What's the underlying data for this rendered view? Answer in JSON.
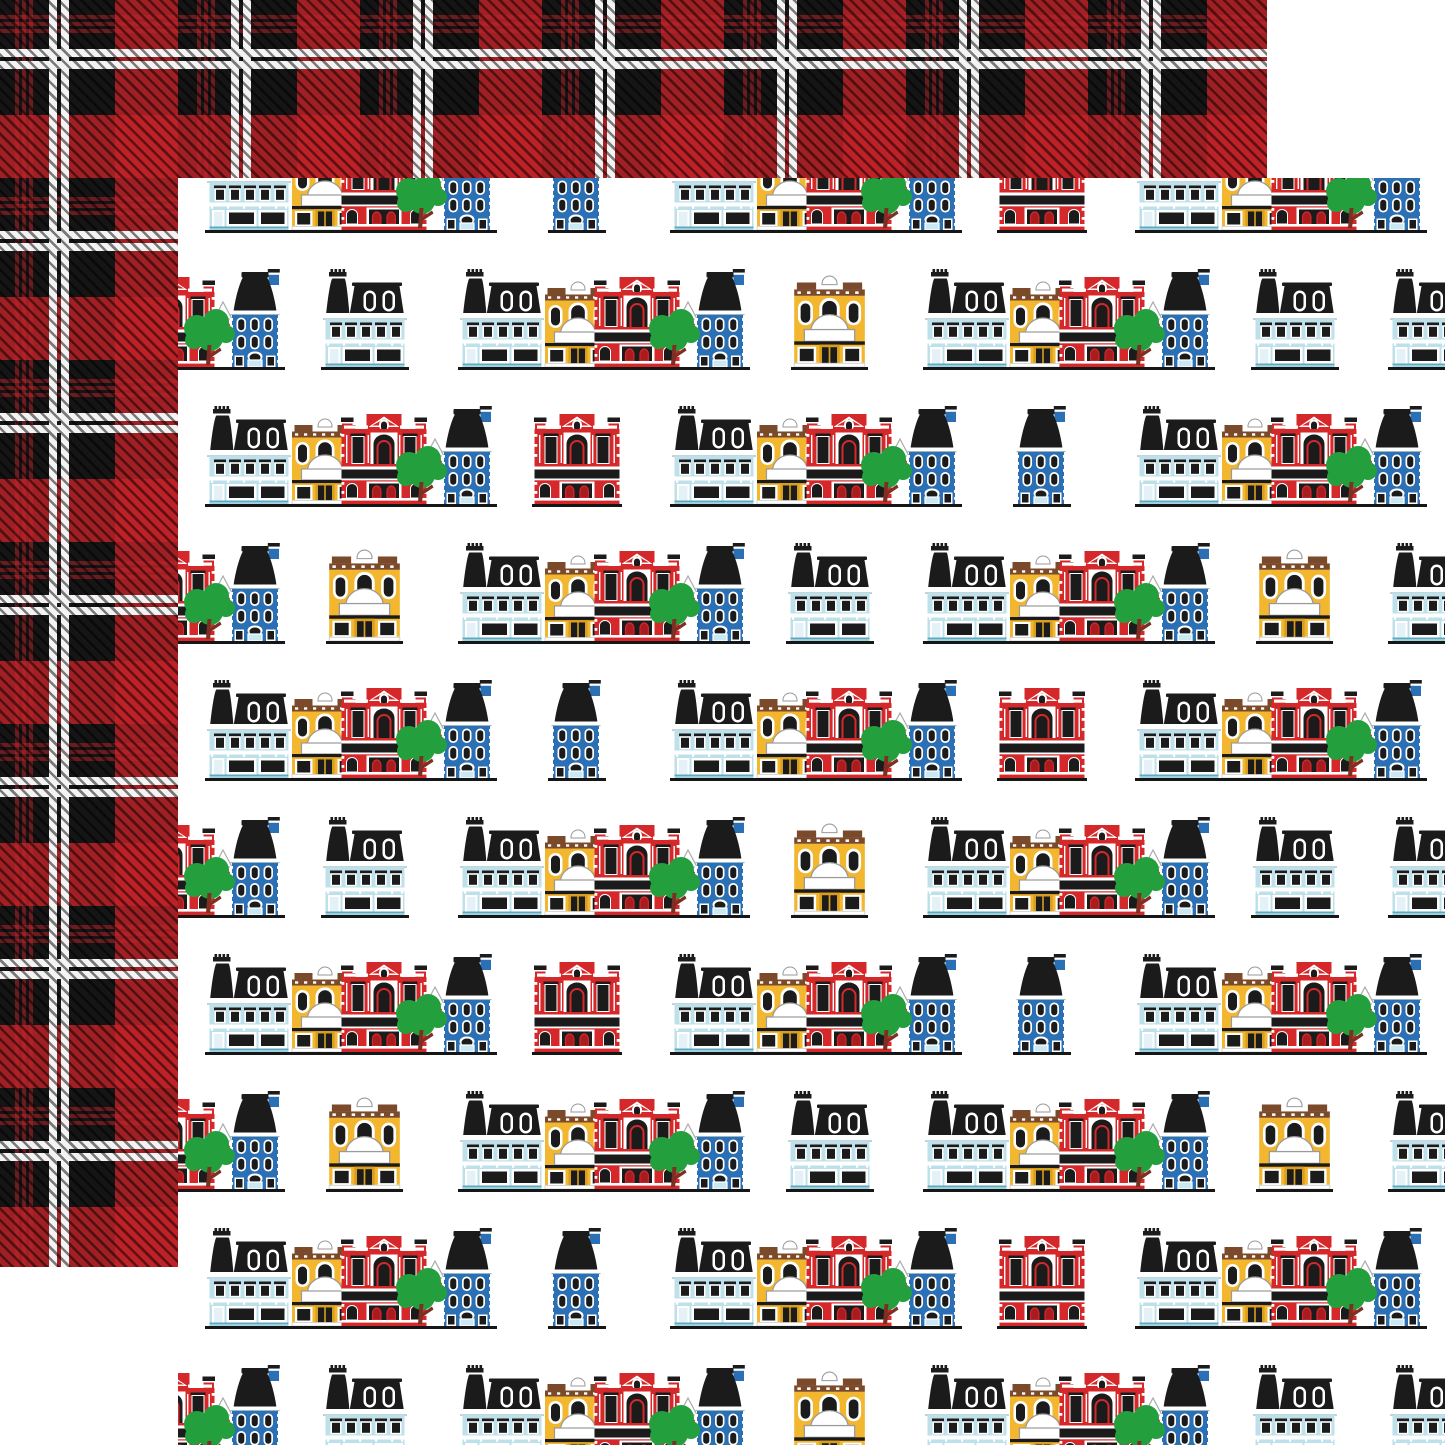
{
  "scene": {
    "description": "Two overlapping 12x12 scrapbook paper sheets: red and black buffalo plaid sheet behind (top left), white main-street buildings pattern sheet in front (bottom right)",
    "background_color": "#ffffff",
    "canvas_size": 1445
  },
  "back_sheet": {
    "name": "buffalo-plaid-paper",
    "x": 0,
    "y": 0,
    "size": 1267,
    "pattern": {
      "type": "buffalo-check-tartan-twill",
      "base_color": "#151515",
      "red_band_color": "rgba(196,34,40,0.8)",
      "thin_red_color": "rgba(193,35,42,0.5)",
      "pinstripe_color": "#F3F3F3",
      "period": 182,
      "red_band": [
        115,
        178
      ],
      "pinstripe_pairs": [
        [
          49,
          57
        ],
        [
          61,
          69
        ]
      ],
      "thin_red_lines": [
        [
          15,
          19
        ],
        [
          22,
          26
        ],
        [
          29,
          33
        ]
      ],
      "twill": {
        "angle": 45,
        "dark": "rgba(0,0,0,0.5)",
        "line": 2.6,
        "cycle": 8
      }
    }
  },
  "front_sheet": {
    "name": "main-street-buildings-paper",
    "x": 178,
    "y": 178,
    "size": 1267,
    "background": "#ffffff",
    "row_layout": {
      "first_row_bottom": 52,
      "row_spacing": 137,
      "cluster_width": 292,
      "cluster_height": 101,
      "type1_cluster_x": [
        27,
        492,
        957
      ],
      "type2_cluster_x": [
        -185,
        280,
        745,
        1210
      ],
      "type1_lone_centers": [
        399,
        864
      ],
      "type2_lone_centers": [
        187,
        652,
        1117
      ]
    },
    "cluster_sequence": [
      "light-blue-victorian",
      "yellow-dome-shop",
      "red-building",
      "gable-connector",
      "blue-rowhouse",
      "tree"
    ],
    "rows": [
      {
        "type": 1,
        "lones": [
          "blue-rowhouse",
          "red-building"
        ]
      },
      {
        "type": 2,
        "lones": [
          "light-blue-victorian",
          "yellow-dome-shop",
          "light-blue-victorian"
        ]
      },
      {
        "type": 1,
        "lones": [
          "red-building",
          "blue-rowhouse"
        ]
      },
      {
        "type": 2,
        "lones": [
          "yellow-dome-shop",
          "light-blue-victorian",
          "yellow-dome-shop"
        ]
      },
      {
        "type": 1,
        "lones": [
          "blue-rowhouse",
          "red-building"
        ]
      },
      {
        "type": 2,
        "lones": [
          "light-blue-victorian",
          "yellow-dome-shop",
          "light-blue-victorian"
        ]
      },
      {
        "type": 1,
        "lones": [
          "red-building",
          "blue-rowhouse"
        ]
      },
      {
        "type": 2,
        "lones": [
          "yellow-dome-shop",
          "light-blue-victorian",
          "yellow-dome-shop"
        ]
      },
      {
        "type": 1,
        "lones": [
          "blue-rowhouse",
          "red-building"
        ]
      },
      {
        "type": 2,
        "lones": [
          "light-blue-victorian",
          "yellow-dome-shop",
          "light-blue-victorian"
        ]
      }
    ],
    "buildings": {
      "light-blue-victorian": {
        "symbol": "sym-lightblue",
        "vw": 88,
        "vh": 98,
        "scale": 1
      },
      "yellow-dome-shop": {
        "symbol": "sym-yellow",
        "vw": 72,
        "vh": 86,
        "scale": 1.07
      },
      "red-building": {
        "symbol": "sym-red",
        "vw": 90,
        "vh": 90,
        "scale": 1
      },
      "blue-rowhouse": {
        "symbol": "sym-blue",
        "vw": 58,
        "vh": 98,
        "scale": 1
      }
    },
    "palette": {
      "building_red": "#D5282B",
      "building_red_dark": "#A81C20",
      "building_blue": "#2B70B5",
      "light_blue": "#BDE0EA",
      "pale_blue": "#C9E8F4",
      "yellow": "#F2B62F",
      "yellow_dark": "#D79E1F",
      "brown": "#7B4A2B",
      "green": "#23A03D",
      "trunk": "#7C2F22",
      "ink": "#1B1B1B",
      "baseline": "#161616",
      "white": "#FFFFFF"
    }
  }
}
